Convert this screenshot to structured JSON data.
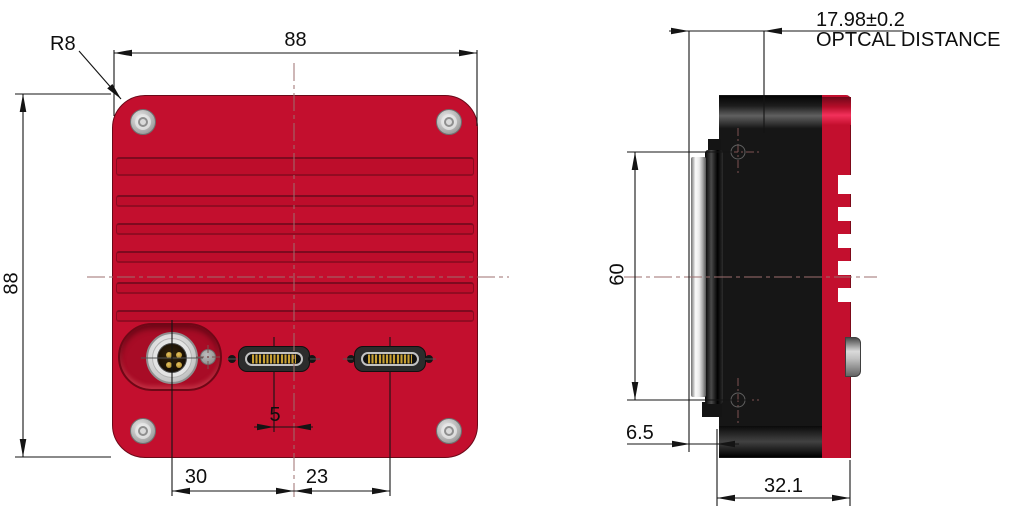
{
  "back_view": {
    "corner_radius": "R8",
    "width": "88",
    "height": "88",
    "connector_offset": "5",
    "power_to_center": "30",
    "center_to_data": "23"
  },
  "side_view": {
    "mount_hole_spacing": "60",
    "flange_depth": "6.5",
    "body_depth": "32.1",
    "optical_distance": "17.98±0.2",
    "optical_distance_label": "OPTCAL DISTANCE"
  }
}
